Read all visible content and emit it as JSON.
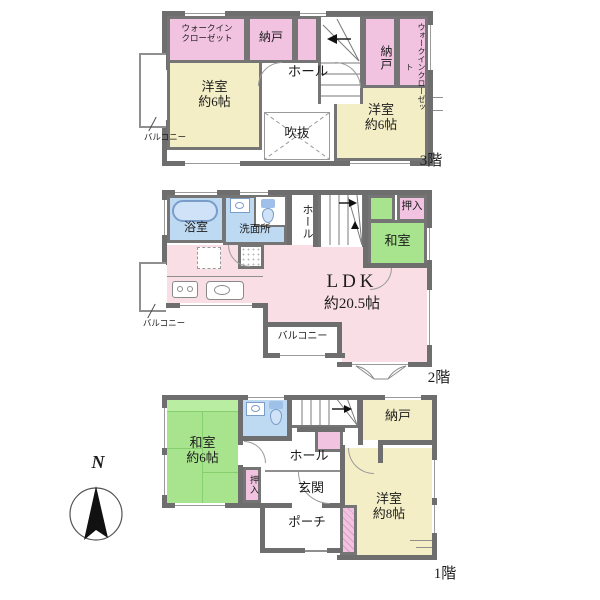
{
  "colors": {
    "wall": "#6e6e6e",
    "closet_pink": "#f2c3e1",
    "ldk_pale_pink": "#f9dfe5",
    "western_room_cream": "#f4eec6",
    "tatami_green": "#a8e38e",
    "wet_area_blue": "#bedaf3"
  },
  "compass": {
    "north_label": "N"
  },
  "floor3": {
    "floor_label": "3階",
    "rooms": {
      "wic_left_l1": "ウォークイン",
      "wic_left_l2": "クローゼット",
      "nando_top": "納戸",
      "nando_right": "納戸",
      "wic_right": "ウォークインクローゼット",
      "yoshitsu_left_name": "洋室",
      "yoshitsu_left_size": "約6帖",
      "hall": "ホール",
      "fukinuke": "吹抜",
      "yoshitsu_right_name": "洋室",
      "yoshitsu_right_size": "約6帖",
      "balcony": "バルコニー"
    }
  },
  "floor2": {
    "floor_label": "2階",
    "rooms": {
      "bath": "浴室",
      "washroom": "洗面所",
      "hall": "ホール",
      "oshiire": "押入",
      "washitsu": "和室",
      "ldk_name": "LDK",
      "ldk_size": "約20.5帖",
      "balcony_left": "バルコニー",
      "balcony_bottom": "バルコニー"
    }
  },
  "floor1": {
    "floor_label": "1階",
    "rooms": {
      "washitsu_name": "和室",
      "washitsu_size": "約6帖",
      "oshiire": "押入",
      "hall": "ホール",
      "genkan": "玄関",
      "porch": "ポーチ",
      "nando": "納戸",
      "yoshitsu_name": "洋室",
      "yoshitsu_size": "約8帖"
    }
  }
}
